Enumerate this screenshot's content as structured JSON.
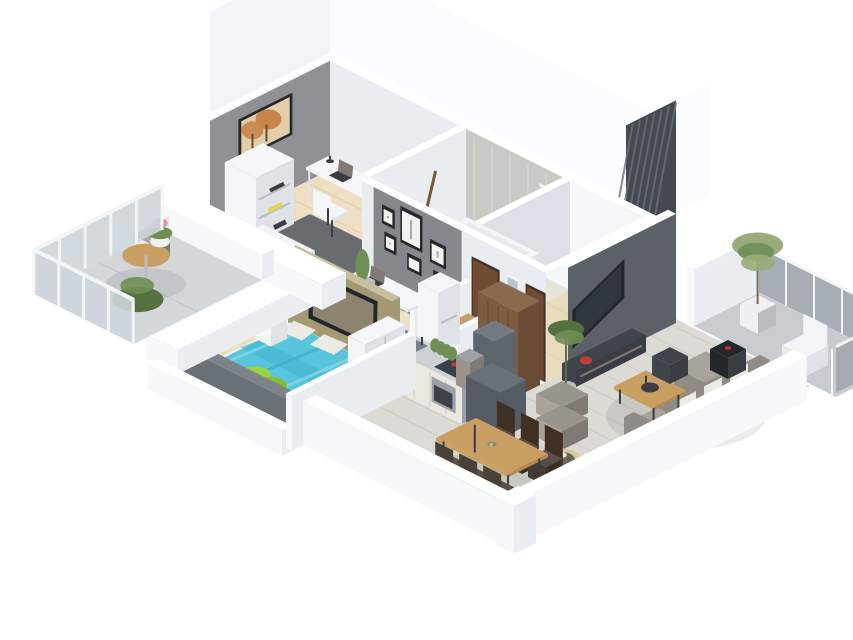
{
  "scene": {
    "title": "3D isometric apartment floor plan",
    "description": "Photorealistic cutaway 3D floor plan render of a furnished apartment viewed from above at an angle, on a plain white background. No text is visible in the image.",
    "projection": "isometric cutaway, walls partially removed",
    "background": "#ffffff"
  },
  "palette": {
    "wallTop": "#ffffff",
    "wallFace": "#e9ecf0",
    "wallFaceShade": "#dde1e7",
    "wallBright": "#f6f8fa",
    "slabWhite": "#fbfcfd",
    "slabShade": "#f1f3f6",
    "grayWall": "#8f9094",
    "framesWall": "#85878b",
    "concrete": "#c9cac6",
    "concreteStreak": "#d6d7d3",
    "woodFloor": "#ecdfc2",
    "woodFloorLine": "#ddcda9",
    "hallFloor": "#e9dcbd",
    "tileFloor": "#e7e3d9",
    "grayFloor": "#dcdad4",
    "plankLine": "#cbc8c1",
    "balconyFloor": "#d4d7d9",
    "balconyFloorNE": "#c8ccd0",
    "glass": "#cdd5db",
    "glassDark": "#a2a9b1",
    "railWhite": "#f2f4f6",
    "tvWall": "#5c6168",
    "slatDark": "#44494f",
    "slatLine": "#6a707a",
    "tvBlack": "#23272c",
    "tvScreen": "#8d8470",
    "consoleDark": "#3f444b",
    "woodFurn": "#c99e63",
    "woodFurnShade": "#b18a56",
    "woodDark": "#8a6a4e",
    "doorBrown": "#6e4b33",
    "doorFrame": "#402f23",
    "pantryBrown": "#7d5c42",
    "pantryShade": "#6b4c36",
    "sofaGray": "#908c85",
    "sofaShade": "#7f7b74",
    "cushion": "#a8a39b",
    "pillowWhite": "#eceae5",
    "pouf": "#9a948c",
    "bedCyan": "#58c5dc",
    "bedCyanShade": "#3fb2cc",
    "bedCyanLight": "#7fd4e6",
    "bedGreen": "#9ed23f",
    "bedGreenShade": "#86bd2e",
    "bedFrame": "#f3f5f7",
    "tealRug": "#2cb4c9",
    "rugDark": "#686b70",
    "oliveTan": "#a39a74",
    "oliveTop": "#c7bfa0",
    "deskWhite": "#f4f6f8",
    "deskShade": "#dfe3e8",
    "chairDark": "#3a3e44",
    "steel": "#9aa2a8",
    "ivory": "#eae8e1",
    "counterTop": "#ccd1d5",
    "sinkGray": "#788089",
    "cooktop": "#394048",
    "redAccent": "#c43b3b",
    "pinkPot": "#c46a86",
    "fridge": "#5f656d",
    "fridgeTop": "#747a82",
    "plantGreen": "#6f8f55",
    "plantDark": "#55713f",
    "plantPale": "#9aac79",
    "potWhite": "#eef0f2",
    "potGray": "#b9bdc2",
    "accentOrange": "#c98447",
    "artPale": "#e2cfa9",
    "frameBlack": "#26282c",
    "frameInner": "#f2f2ef",
    "mirror": "#b7c5cd",
    "towelPurple": "#9b6b9e",
    "yellowAccent": "#e8d44f",
    "petBedTan": "#d8c9a8",
    "petBedIn": "#6b6458",
    "darkWall": "#6a7077",
    "darkWallTop": "#7d838b",
    "sideboard": "#565c64",
    "sideboardTop": "#6a7078",
    "shadow": "rgba(0,0,0,0.08)"
  },
  "rooms": [
    {
      "id": "study",
      "label": "Home office / study",
      "furniture": [
        "white desk with laptop",
        "desk lamp",
        "chair",
        "bookshelf",
        "acoustic guitar",
        "yellow drawer unit",
        "radiator",
        "dark gray rug",
        "framed orange tree artwork on gray wall"
      ]
    },
    {
      "id": "bathroom",
      "label": "Bathroom",
      "furniture": [
        "built-in bathtub with wood deck",
        "wood vanity with white basin",
        "wall mirror"
      ]
    },
    {
      "id": "entry-hall",
      "label": "Entry hall",
      "furniture": [
        "brown entry door",
        "tall mirror",
        "second brown door",
        "gallery wall with six black picture frames"
      ]
    },
    {
      "id": "guest-wc",
      "label": "Guest WC",
      "furniture": [
        "wood washbasin cabinet",
        "white basin",
        "purple towels"
      ]
    },
    {
      "id": "kitchen",
      "label": "Kitchen",
      "furniture": [
        "counter with gray sink",
        "cooktop with red pots",
        "stainless oven",
        "row of green herb plants",
        "dark refrigerator",
        "brown pantry cabinet"
      ]
    },
    {
      "id": "work-nook",
      "label": "Work nook",
      "furniture": [
        "white desk with laptop",
        "black office chair",
        "teal rug",
        "cactus planter",
        "white cabinet"
      ]
    },
    {
      "id": "bedroom",
      "label": "Bedroom",
      "furniture": [
        "double bed with cyan duvet",
        "green pillow roll",
        "white pillows",
        "white nightstand",
        "TV on olive panel",
        "white wardrobe",
        "dark footwall"
      ]
    },
    {
      "id": "living-room",
      "label": "Living room",
      "furniture": [
        "dark media wall with TV",
        "slatted stair panel",
        "media console with red book",
        "gray sofa with white pillows",
        "black tray table",
        "wood coffee table",
        "side table",
        "two gray poufs",
        "round pet bed",
        "tall potted plant"
      ]
    },
    {
      "id": "dining-area",
      "label": "Dining area",
      "furniture": [
        "wood dining table",
        "six dark chairs",
        "small table plant",
        "dark sideboard"
      ]
    },
    {
      "id": "west-balcony",
      "label": "West balcony",
      "furniture": [
        "glass railing",
        "round bistro table",
        "chair",
        "green shrub",
        "flowering pot"
      ]
    },
    {
      "id": "east-balcony",
      "label": "East balcony",
      "furniture": [
        "gray glass railing",
        "tall potted plant",
        "white lounge chair"
      ]
    }
  ]
}
